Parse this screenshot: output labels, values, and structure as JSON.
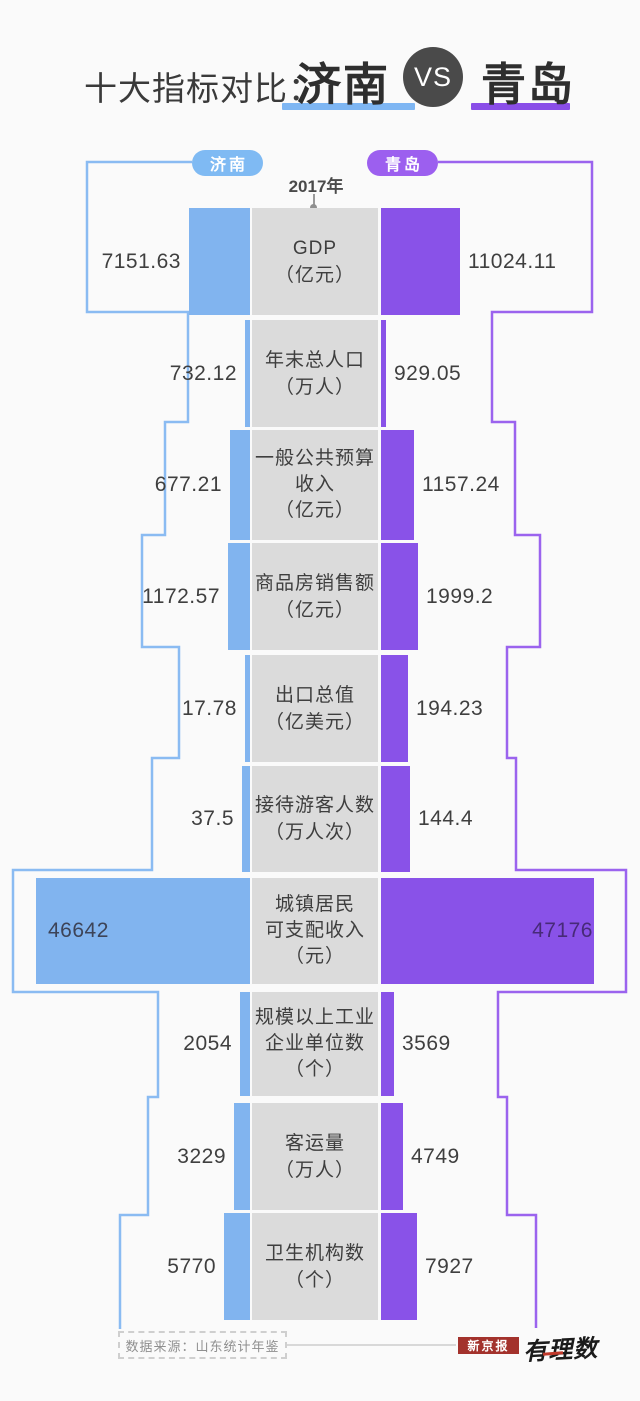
{
  "header": {
    "title_prefix": "十大指标对比：",
    "title_left_city": "济南",
    "title_vs": "VS",
    "title_right_city": "青岛",
    "underline_left_color": "#7EB6F3",
    "underline_right_color": "#8A4EE8"
  },
  "legend": {
    "left_pill": "济南",
    "right_pill": "青岛",
    "year_label": "2017年",
    "left_pill_color": "#7FBAF3",
    "right_pill_color": "#9C5FEF"
  },
  "chart_data": {
    "type": "bar",
    "orientation": "bidirectional-horizontal",
    "title": "十大指标对比：济南 VS 青岛",
    "year": "2017年",
    "legend_position": "top",
    "series": [
      {
        "name": "济南",
        "color": "#81B4EF",
        "outline_color": "#8ABBF2"
      },
      {
        "name": "青岛",
        "color": "#8952E8",
        "outline_color": "#9B63EE"
      }
    ],
    "center_column_color": "#DBDBDB",
    "rows": [
      {
        "label_lines": [
          "GDP",
          "（亿元）"
        ],
        "jinan": "7151.63",
        "qingdao": "11024.11",
        "top": 208,
        "height": 107,
        "bar_jinan_px": 61,
        "bar_qingdao_px": 79,
        "env_left": 87,
        "env_right": 592,
        "values_inside": false
      },
      {
        "label_lines": [
          "年末总人口",
          "（万人）"
        ],
        "jinan": "732.12",
        "qingdao": "929.05",
        "top": 320,
        "height": 107,
        "bar_jinan_px": 5,
        "bar_qingdao_px": 5,
        "env_left": 188,
        "env_right": 492,
        "values_inside": false
      },
      {
        "label_lines": [
          "一般公共预算",
          "收入",
          "（亿元）"
        ],
        "jinan": "677.21",
        "qingdao": "1157.24",
        "top": 430,
        "height": 110,
        "bar_jinan_px": 20,
        "bar_qingdao_px": 33,
        "env_left": 165,
        "env_right": 515,
        "values_inside": false
      },
      {
        "label_lines": [
          "商品房销售额",
          "（亿元）"
        ],
        "jinan": "1172.57",
        "qingdao": "1999.2",
        "top": 543,
        "height": 107,
        "bar_jinan_px": 22,
        "bar_qingdao_px": 37,
        "env_left": 142,
        "env_right": 540,
        "values_inside": false
      },
      {
        "label_lines": [
          "出口总值",
          "（亿美元）"
        ],
        "jinan": "17.78",
        "qingdao": "194.23",
        "top": 655,
        "height": 107,
        "bar_jinan_px": 5,
        "bar_qingdao_px": 27,
        "env_left": 179,
        "env_right": 507,
        "values_inside": false
      },
      {
        "label_lines": [
          "接待游客人数",
          "（万人次）"
        ],
        "jinan": "37.5",
        "qingdao": "144.4",
        "top": 766,
        "height": 106,
        "bar_jinan_px": 8,
        "bar_qingdao_px": 29,
        "env_left": 152,
        "env_right": 516,
        "values_inside": false
      },
      {
        "label_lines": [
          "城镇居民",
          "可支配收入",
          "（元）"
        ],
        "jinan": "46642",
        "qingdao": "47176",
        "top": 878,
        "height": 106,
        "bar_jinan_px": 214,
        "bar_qingdao_px": 213,
        "env_left": 13,
        "env_right": 626,
        "values_inside": true
      },
      {
        "label_lines": [
          "规模以上工业",
          "企业单位数",
          "（个）"
        ],
        "jinan": "2054",
        "qingdao": "3569",
        "top": 992,
        "height": 104,
        "bar_jinan_px": 10,
        "bar_qingdao_px": 13,
        "env_left": 158,
        "env_right": 498,
        "values_inside": false
      },
      {
        "label_lines": [
          "客运量",
          "（万人）"
        ],
        "jinan": "3229",
        "qingdao": "4749",
        "top": 1103,
        "height": 107,
        "bar_jinan_px": 16,
        "bar_qingdao_px": 22,
        "env_left": 148,
        "env_right": 507,
        "values_inside": false
      },
      {
        "label_lines": [
          "卫生机构数",
          "（个）"
        ],
        "jinan": "5770",
        "qingdao": "7927",
        "top": 1213,
        "height": 107,
        "bar_jinan_px": 26,
        "bar_qingdao_px": 36,
        "env_left": 120,
        "env_right": 536,
        "values_inside": false
      }
    ],
    "envelope": {
      "top_y": 162,
      "step_ys": [
        312,
        422,
        535,
        647,
        758,
        870,
        992,
        1097,
        1215
      ],
      "left_end_y": 1329,
      "right_end_y": 1328,
      "left_start_x": 192,
      "right_start_x": 438
    },
    "geometry": {
      "bar_left_edge": 250,
      "bar_right_edge": 381,
      "center_left": 252,
      "center_width": 126
    }
  },
  "footer": {
    "source_text": "数据来源：山东统计年鉴",
    "logo_beijing_news": "新京报",
    "logo_youlishu": "有理数"
  }
}
